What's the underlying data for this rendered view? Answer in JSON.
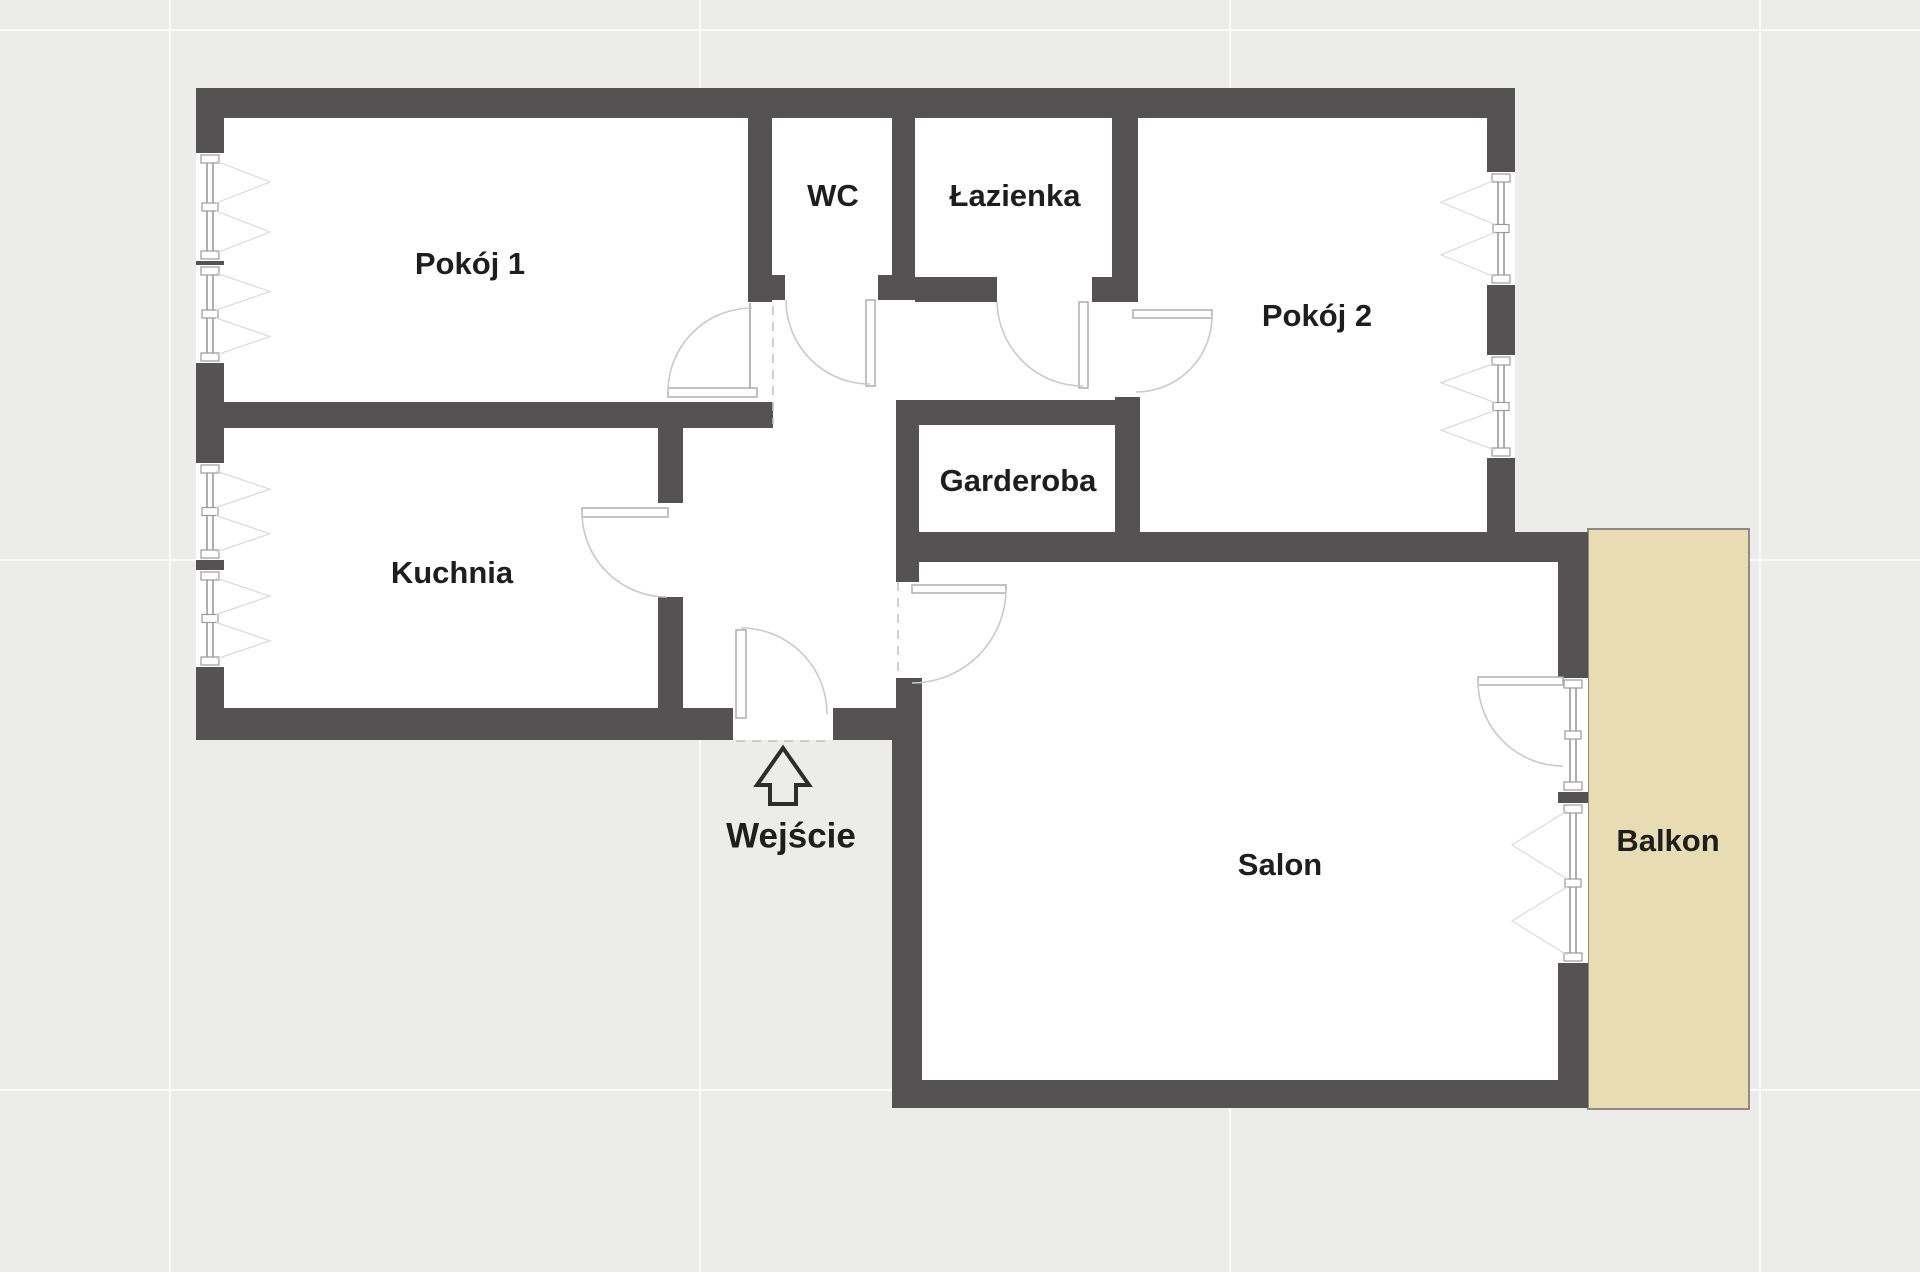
{
  "plan": {
    "title": "Apartment floor plan",
    "rooms": [
      {
        "id": "pokoj-1",
        "label": "Pokój 1"
      },
      {
        "id": "wc",
        "label": "WC"
      },
      {
        "id": "lazienka",
        "label": "Łazienka"
      },
      {
        "id": "pokoj-2",
        "label": "Pokój 2"
      },
      {
        "id": "kuchnia",
        "label": "Kuchnia"
      },
      {
        "id": "garderoba",
        "label": "Garderoba"
      },
      {
        "id": "salon",
        "label": "Salon"
      },
      {
        "id": "balkon",
        "label": "Balkon"
      }
    ],
    "entrance": {
      "label": "Wejście",
      "icon": "up-arrow-icon"
    },
    "colors": {
      "wall": "#555254",
      "background": "#ecedeb",
      "room_fill": "#ffffff",
      "balcony_fill": "#e8dcb4",
      "balcony_border": "#908b7e",
      "label_text": "#1e1e1e"
    }
  }
}
